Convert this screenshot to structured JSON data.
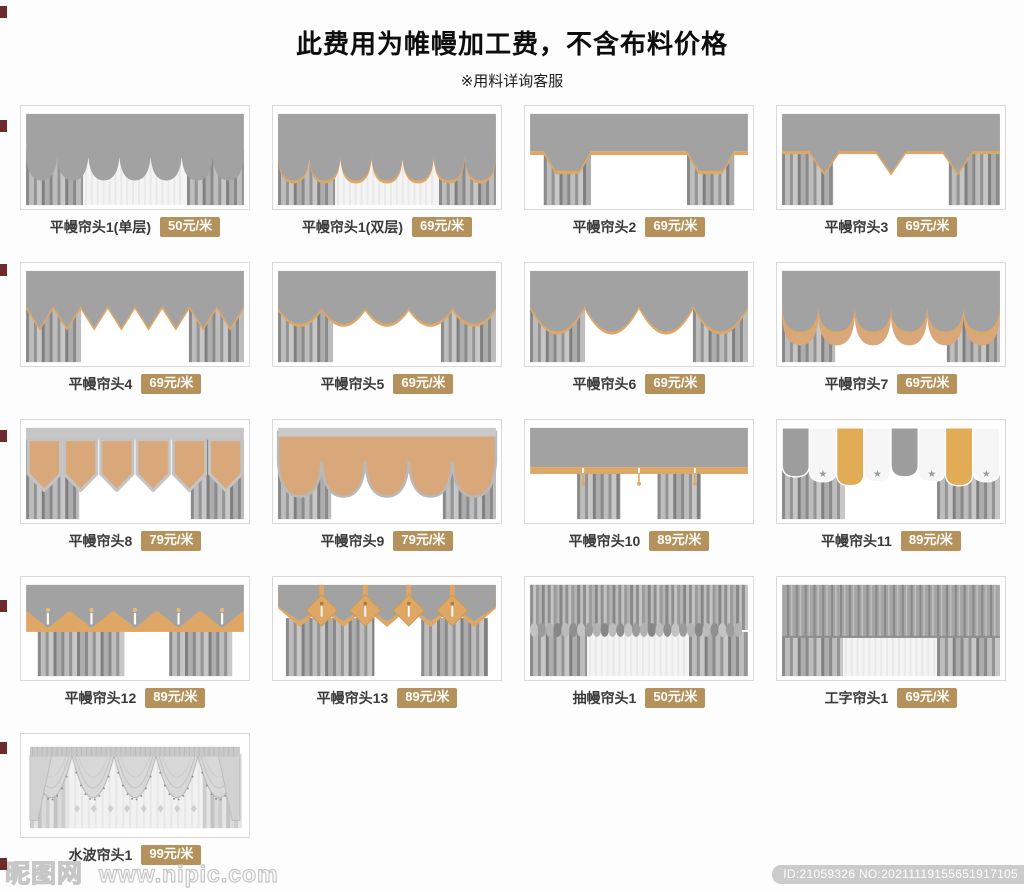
{
  "header": {
    "title": "此费用为帷幔加工费，不含布料价格",
    "subtitle": "※用料详询客服"
  },
  "products": [
    {
      "name": "平幔帘头1(单层)",
      "price": "50元/米",
      "style": "scallop1"
    },
    {
      "name": "平幔帘头1(双层)",
      "price": "69元/米",
      "style": "scallop2"
    },
    {
      "name": "平幔帘头2",
      "price": "69元/米",
      "style": "tails"
    },
    {
      "name": "平幔帘头3",
      "price": "69元/米",
      "style": "points"
    },
    {
      "name": "平幔帘头4",
      "price": "69元/米",
      "style": "zigzag"
    },
    {
      "name": "平幔帘头5",
      "price": "69元/米",
      "style": "wave"
    },
    {
      "name": "平幔帘头6",
      "price": "69元/米",
      "style": "wave2"
    },
    {
      "name": "平幔帘头7",
      "price": "69元/米",
      "style": "scallop-tan"
    },
    {
      "name": "平幔帘头8",
      "price": "79元/米",
      "style": "pennant"
    },
    {
      "name": "平幔帘头9",
      "price": "79元/米",
      "style": "tan-scallop"
    },
    {
      "name": "平幔帘头10",
      "price": "89元/米",
      "style": "band-tassel"
    },
    {
      "name": "平幔帘头11",
      "price": "89元/米",
      "style": "banner-star"
    },
    {
      "name": "平幔帘头12",
      "price": "89元/米",
      "style": "zigzag-band"
    },
    {
      "name": "平幔帘头13",
      "price": "89元/米",
      "style": "diamond"
    },
    {
      "name": "抽幔帘头1",
      "price": "50元/米",
      "style": "ruched"
    },
    {
      "name": "工字帘头1",
      "price": "69元/米",
      "style": "box-pleat"
    },
    {
      "name": "水波帘头1",
      "price": "99元/米",
      "style": "swag"
    }
  ],
  "footer": {
    "watermark_logo": "昵图网",
    "watermark_url": "www.nipic.com",
    "id_text": "ID:21059326 NO:20211119155651917105"
  },
  "colors": {
    "badge": "#b5925c",
    "gold": "#dfa766",
    "tan": "#d8a87a",
    "banner_gold": "#e2ab55",
    "valance_gray": "#a2a2a2"
  }
}
